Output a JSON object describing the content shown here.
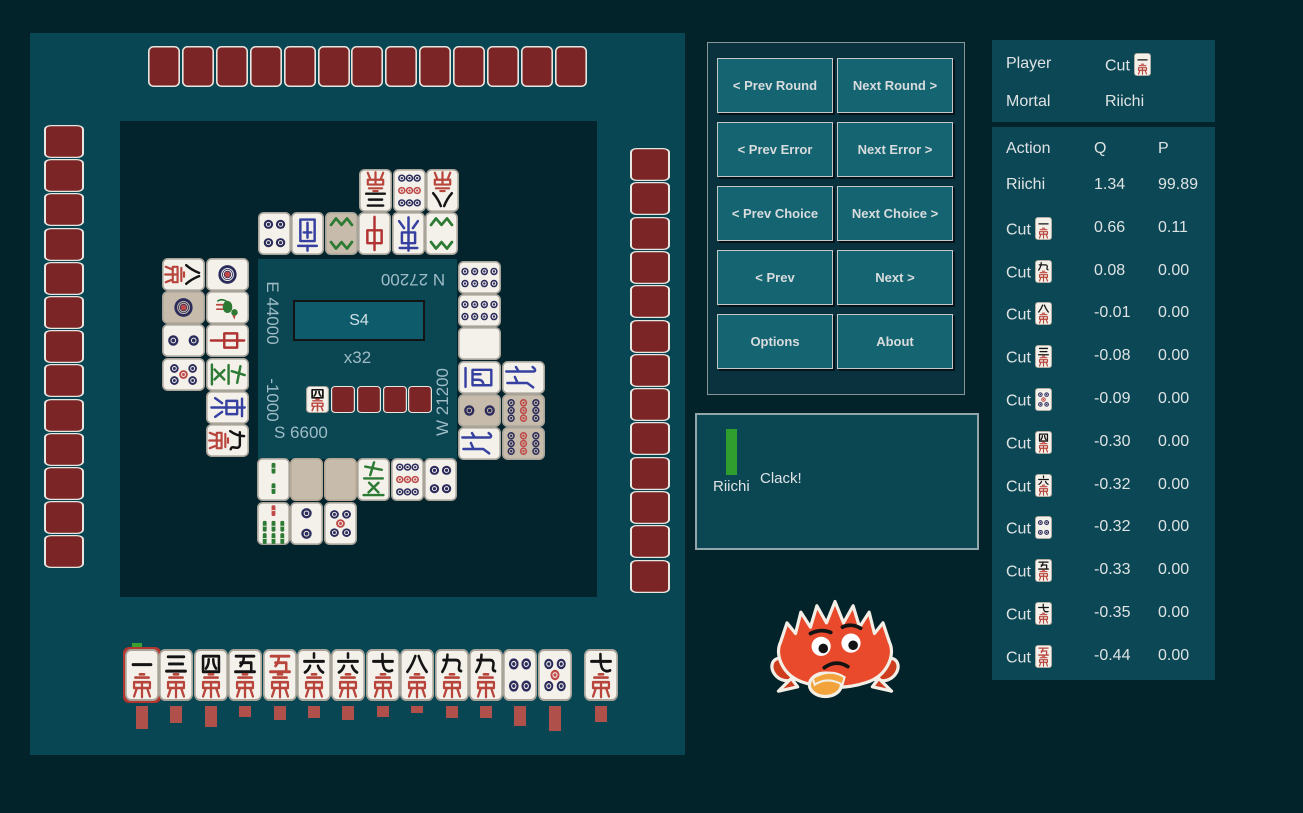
{
  "colors": {
    "page_bg": "#03232b",
    "left_panel": "#074652",
    "board_bg": "#04242d",
    "center_square": "#0b4653",
    "round_box": "#0e5b6b",
    "button_fill": "#156472",
    "button_panel": "#0a323e",
    "panel": "#0b4754",
    "tile_face": "#f4f1ea",
    "tile_tan": "#c7bcab",
    "tile_back": "#7b2527",
    "bar_red": "#b0504a",
    "green_bar": "#2f9e2f",
    "score_text": "#9fbcc6",
    "pin_navy": "#2b2c5c",
    "pin_red": "#bf4848",
    "sou_green": "#2c7a33",
    "wind_blue": "#3540a0",
    "man_red": "#b8453c",
    "man_black": "#141414"
  },
  "nav": {
    "buttons": [
      "< Prev Round",
      "Next Round >",
      "< Prev Error",
      "Next Error >",
      "< Prev Choice",
      "Next Choice >",
      "< Prev",
      "Next >",
      "Options",
      "About"
    ]
  },
  "players": {
    "player_label": "Player",
    "player_action": "Cut",
    "player_tile": "1m",
    "mortal_label": "Mortal",
    "mortal_action": "Riichi"
  },
  "review": {
    "headers": [
      "Action",
      "Q",
      "P"
    ],
    "rows": [
      {
        "action": "Riichi",
        "tile": null,
        "q": "1.34",
        "p": "99.89"
      },
      {
        "action": "Cut",
        "tile": "1m",
        "q": "0.66",
        "p": "0.11"
      },
      {
        "action": "Cut",
        "tile": "9m",
        "q": "0.08",
        "p": "0.00"
      },
      {
        "action": "Cut",
        "tile": "8m",
        "q": "-0.01",
        "p": "0.00"
      },
      {
        "action": "Cut",
        "tile": "3m",
        "q": "-0.08",
        "p": "0.00"
      },
      {
        "action": "Cut",
        "tile": "5p",
        "q": "-0.09",
        "p": "0.00"
      },
      {
        "action": "Cut",
        "tile": "4m",
        "q": "-0.30",
        "p": "0.00"
      },
      {
        "action": "Cut",
        "tile": "6m",
        "q": "-0.32",
        "p": "0.00"
      },
      {
        "action": "Cut",
        "tile": "4p",
        "q": "-0.32",
        "p": "0.00"
      },
      {
        "action": "Cut",
        "tile": "5m",
        "q": "-0.33",
        "p": "0.00"
      },
      {
        "action": "Cut",
        "tile": "7m",
        "q": "-0.35",
        "p": "0.00"
      },
      {
        "action": "Cut",
        "tile": "0m",
        "q": "-0.44",
        "p": "0.00"
      }
    ]
  },
  "message": {
    "label": "Riichi",
    "text": "Clack!"
  },
  "center": {
    "round": "S4",
    "wall": "x32",
    "scores": {
      "east": "E 44000",
      "north": "N 27200",
      "west": "W 21200",
      "south": "S 6600",
      "east_delta": "-1000"
    }
  },
  "board": {
    "dora_indicator": "4m",
    "dora_hidden": 4,
    "hand_counts": {
      "north": 13,
      "east": 13,
      "west": 13
    },
    "discards": {
      "north_outer": [
        "3m",
        "9p",
        "8m"
      ],
      "north_inner": [
        "4p",
        "S",
        "8s|tan",
        "C",
        "E",
        "8s"
      ],
      "east_inner": [
        "1p",
        "1s",
        "C",
        "F",
        "E",
        "9m"
      ],
      "east_outer": [
        "8m",
        "1p|tan",
        "2p",
        "5p"
      ],
      "west_inner": [
        "8p",
        "8p",
        "P",
        "W",
        "2p|tan",
        "N"
      ],
      "west_outer": [
        "N",
        "9p|tan",
        "9p|tan"
      ],
      "south_row1": [
        "2s",
        "tan",
        "tan",
        "F",
        "9p",
        "4p"
      ],
      "south_row2": [
        "7s",
        "2p",
        "5p"
      ]
    }
  },
  "hand": {
    "tiles": [
      "1m",
      "3m",
      "4m",
      "5m",
      "0m",
      "6m",
      "6m",
      "7m",
      "8m",
      "9m",
      "9m",
      "4p",
      "5p"
    ],
    "draw": "7m",
    "selected": 0,
    "bars": [
      23,
      17,
      21,
      11,
      14,
      12,
      14,
      11,
      7,
      12,
      12,
      20,
      25
    ],
    "draw_bar": 16
  }
}
